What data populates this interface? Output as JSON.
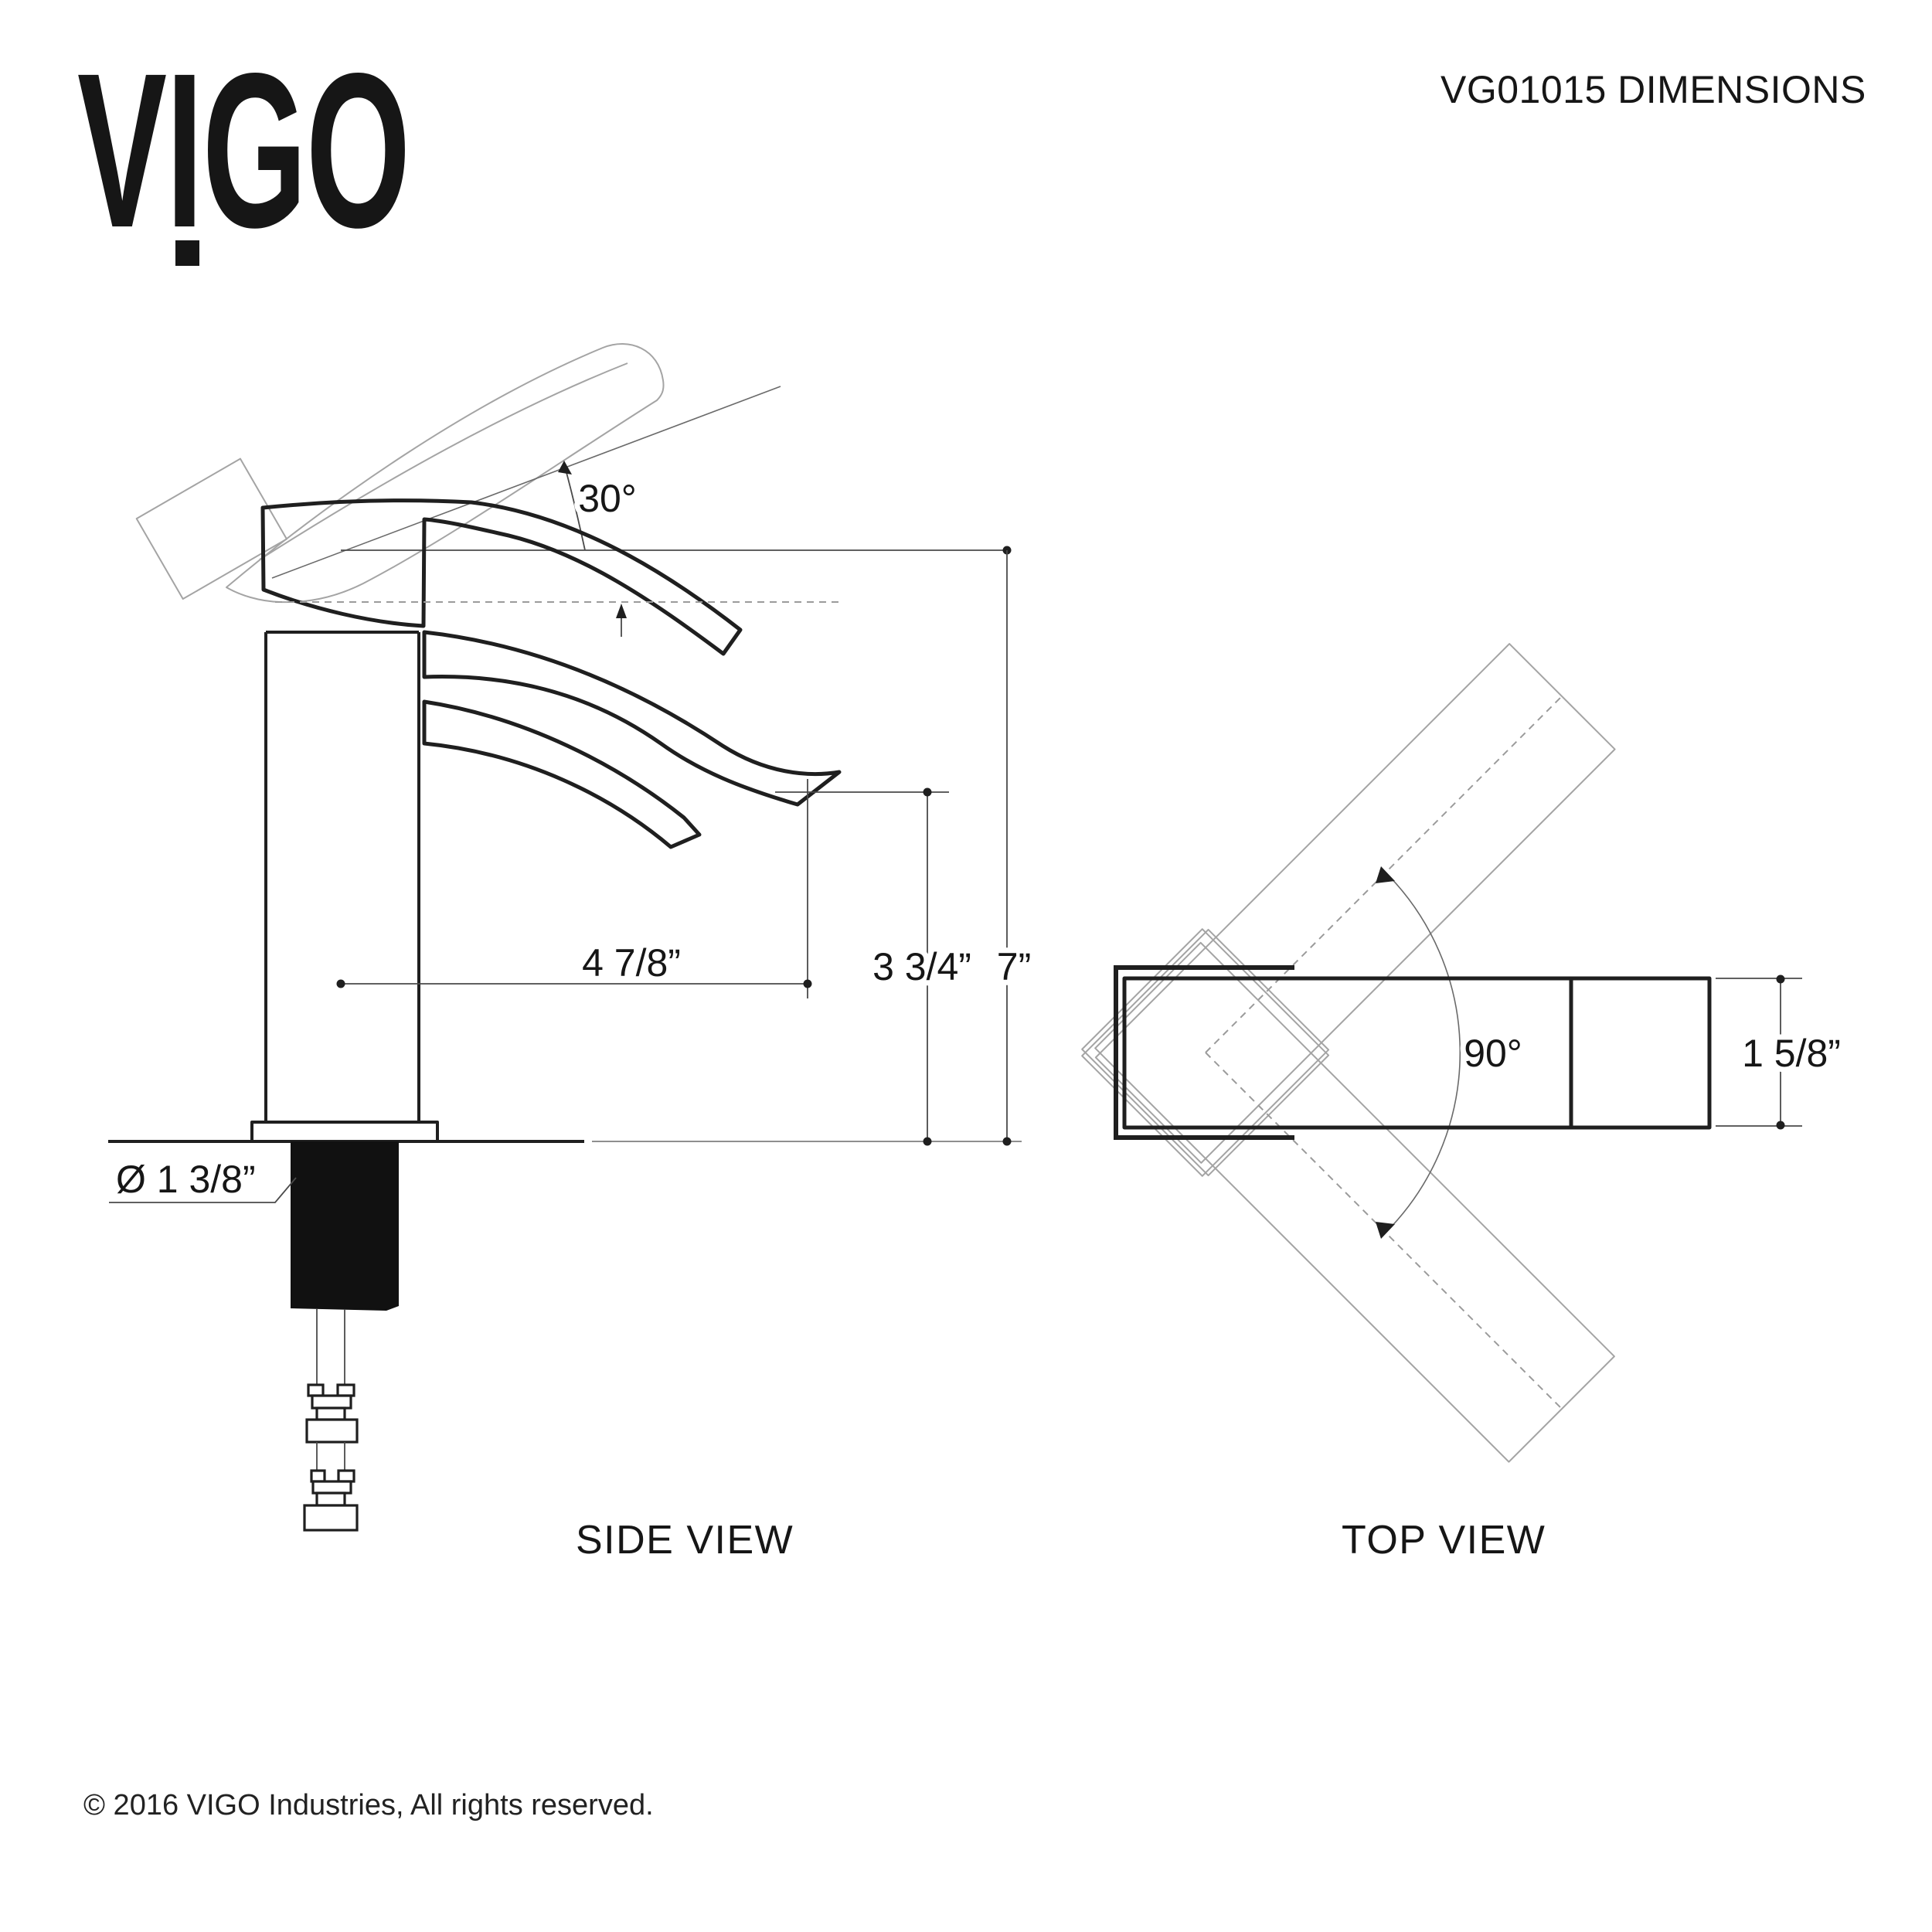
{
  "header": {
    "logo": "VIGO",
    "title": "VG01015 DIMENSIONS"
  },
  "side_view": {
    "label": "SIDE VIEW",
    "dimensions": {
      "handle_angle": "30°",
      "spout_reach": "4 7/8”",
      "spout_height": "3 3/4”",
      "overall_height": "7”",
      "shank_diameter": "Ø 1 3/8”"
    }
  },
  "top_view": {
    "label": "TOP VIEW",
    "dimensions": {
      "handle_swivel": "90°",
      "handle_width": "1 5/8”"
    }
  },
  "footer": {
    "copyright": "© 2016 VIGO Industries, All rights reserved."
  },
  "colors": {
    "background": "#ffffff",
    "line_primary": "#1f1f1f",
    "line_dimension": "#4a4a4a",
    "line_ghost": "#a4a4a4"
  }
}
